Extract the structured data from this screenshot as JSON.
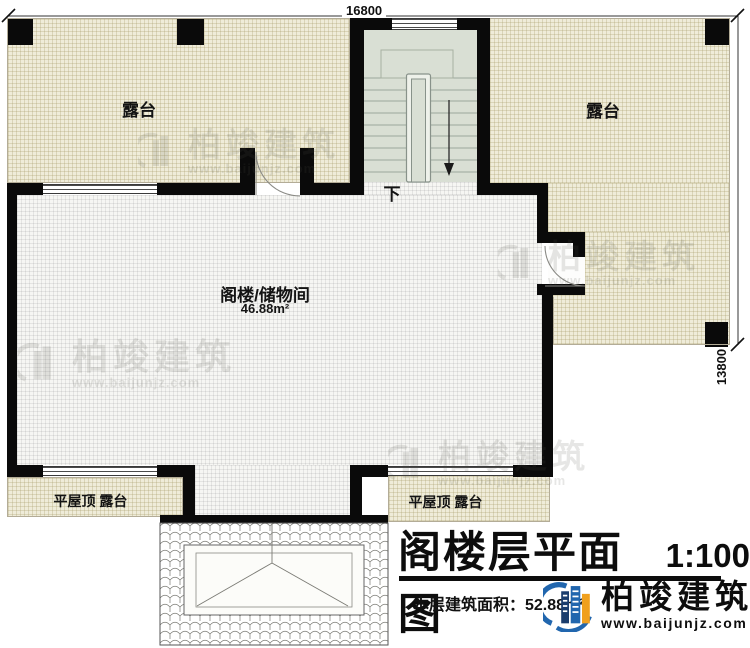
{
  "plan": {
    "dimensions": {
      "top": "16800",
      "right": "13800"
    },
    "rooms": {
      "terrace_top_left": "露台",
      "terrace_right": "露台",
      "attic": {
        "name": "阁楼/储物间",
        "area": "46.88m²"
      },
      "flat_roof_left": "平屋顶 露台",
      "flat_roof_right": "平屋顶 露台",
      "stairs_down": "下"
    }
  },
  "title_block": {
    "title": "阁楼层平面图",
    "scale": "1:100",
    "floor_area": "本层建筑面积：52.88m²"
  },
  "logo": {
    "name": "柏竣建筑",
    "mark": "、",
    "url": "www.baijunjz.com"
  },
  "watermark": {
    "name": "柏竣建筑",
    "url": "www.baijunjz.com"
  },
  "colors": {
    "terrace_fill": "#efecd9",
    "room_fill": "#f6f6f3",
    "stair_fill": "#d9dfd4",
    "wall": "#0a0a0a",
    "logo_blue": "#2166ae",
    "logo_navy": "#1b3d6d",
    "logo_orange": "#f0a01e"
  }
}
